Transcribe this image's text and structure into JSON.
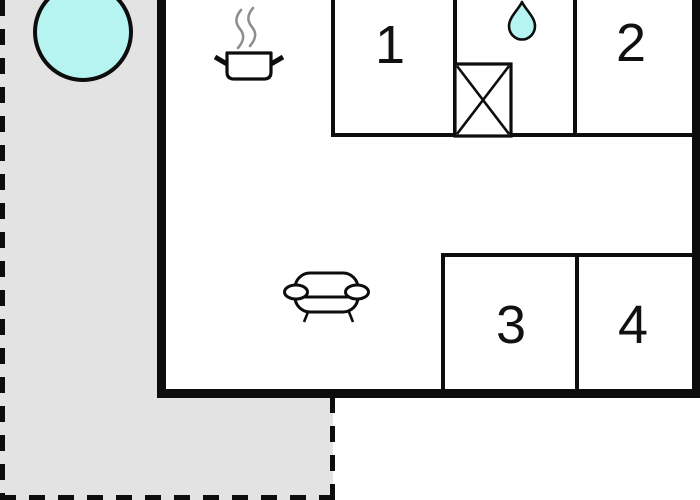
{
  "floorplan": {
    "type": "vacation-home-floor-plan",
    "rooms": [
      {
        "id": "room-1",
        "label": "1"
      },
      {
        "id": "room-2",
        "label": "2"
      },
      {
        "id": "room-3",
        "label": "3"
      },
      {
        "id": "room-4",
        "label": "4"
      }
    ],
    "icons": [
      {
        "name": "hot-tub-icon"
      },
      {
        "name": "cooking-pot-icon"
      },
      {
        "name": "steam-icon"
      },
      {
        "name": "water-drop-icon"
      },
      {
        "name": "shower-box-icon"
      },
      {
        "name": "sofa-icon"
      }
    ]
  },
  "colors": {
    "paper": "#ffffff",
    "terrace": "#e3e3e3",
    "wall": "#0d0d0d",
    "water": "#b5f4f1",
    "steam": "#8e8e8e"
  }
}
